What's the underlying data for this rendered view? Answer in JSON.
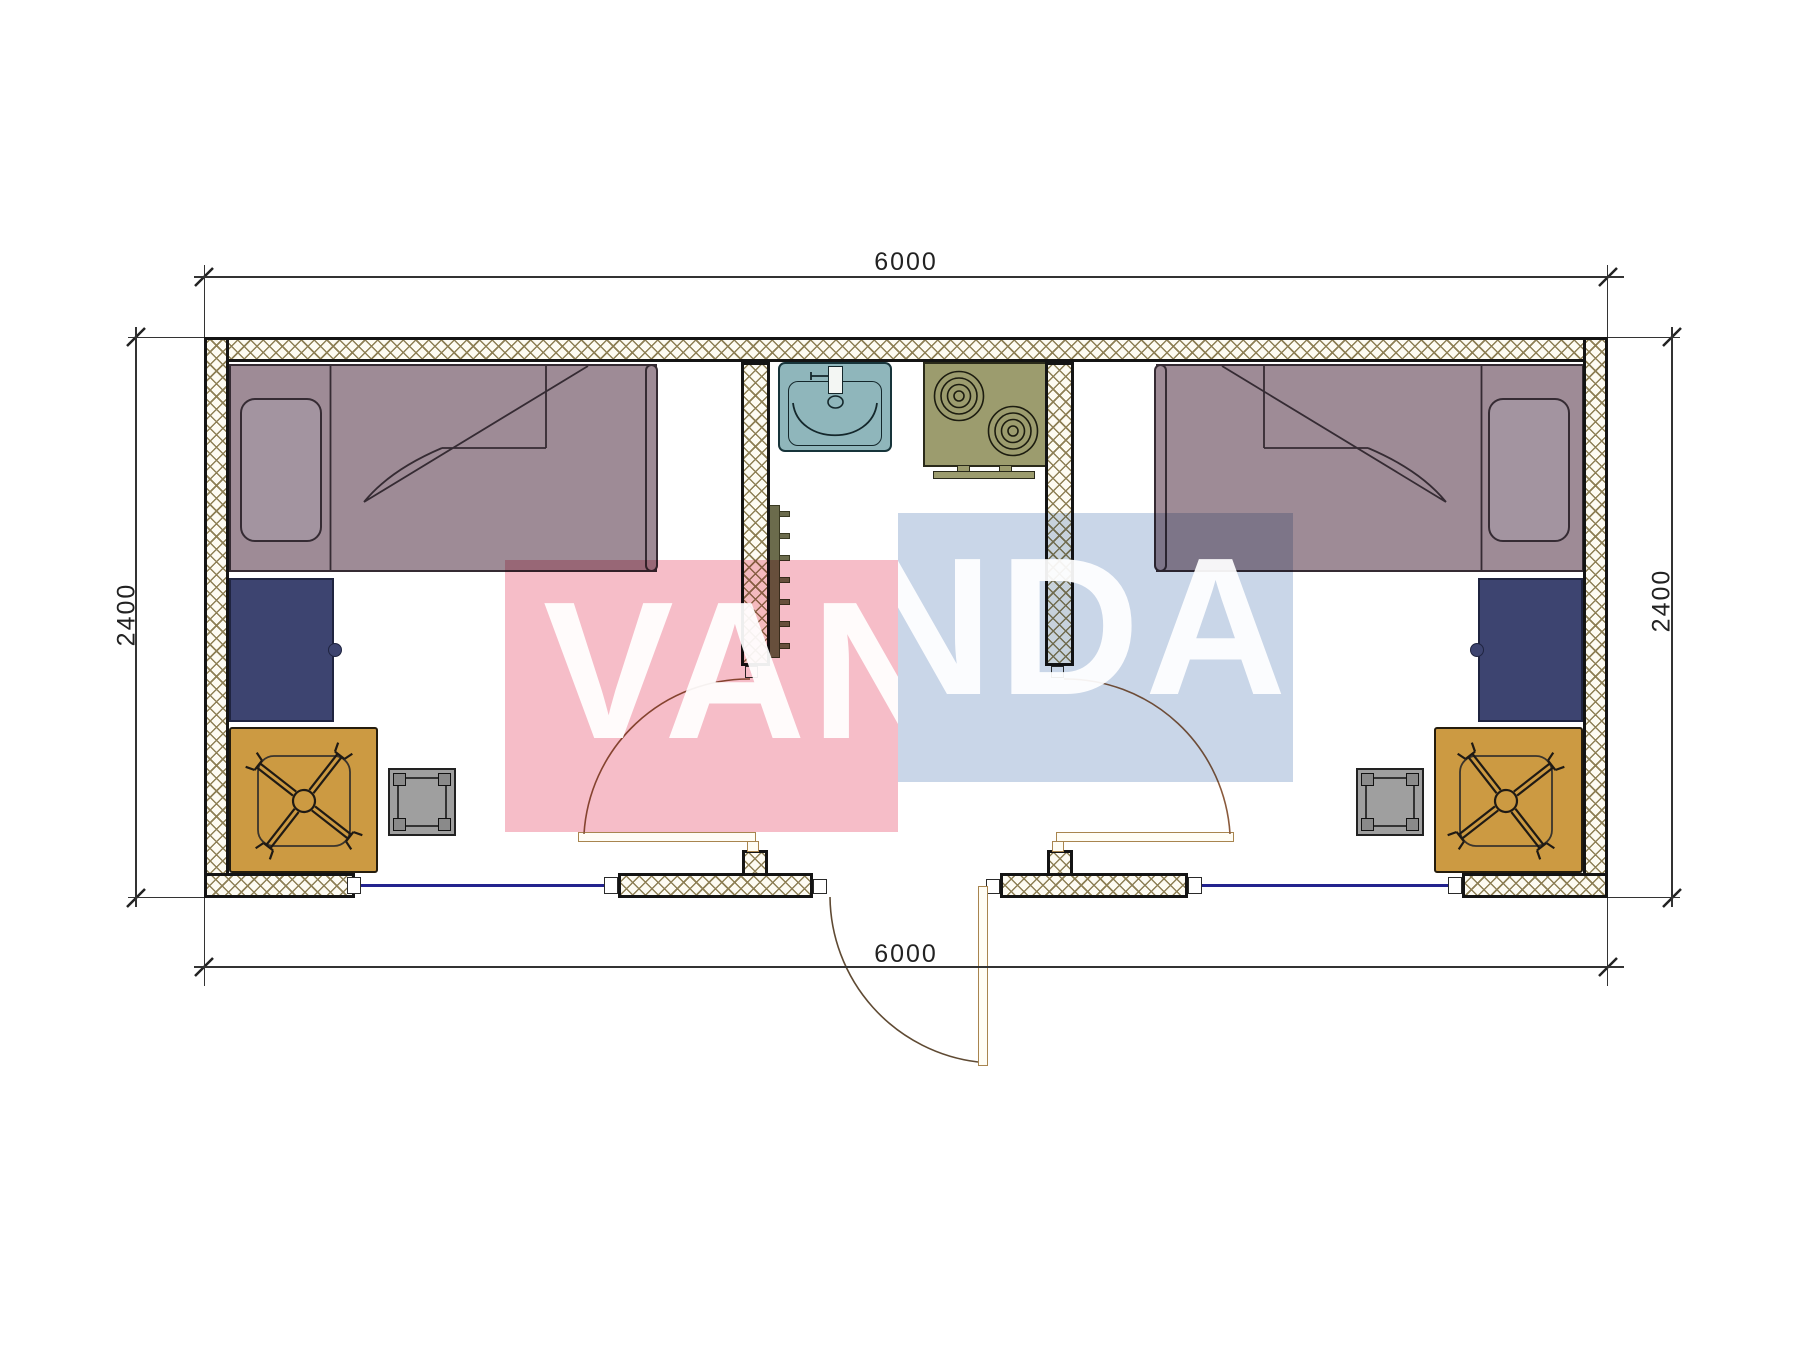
{
  "watermark": {
    "text": "VANDA",
    "pink_color": "#f6bdc8",
    "blue_color": "#c9d6e8"
  },
  "dimensions": {
    "top": "6000",
    "bottom": "6000",
    "left": "2400",
    "right": "2400"
  },
  "plan": {
    "type": "container-house-floor-plan",
    "colors": {
      "wall_hatch": "#8d7f55",
      "wall_outline": "#141414",
      "bed": "#9e8b96",
      "desk": "#3d4470",
      "table": "#cc9a42",
      "stool": "#9f9f9f",
      "sink": "#8fb6bb",
      "stove": "#9c9c6e",
      "window": "#23238e",
      "door_leaf": "#a8854f",
      "door_arc": "#8a5a3c"
    },
    "elements": [
      "bed-left",
      "bed-right",
      "desk-left",
      "desk-right",
      "table-left",
      "table-right",
      "chair-left",
      "chair-right",
      "stool-left",
      "stool-right",
      "sink",
      "stove",
      "radiator",
      "door-left-room",
      "door-right-room",
      "door-exterior",
      "window-left",
      "window-right"
    ]
  }
}
